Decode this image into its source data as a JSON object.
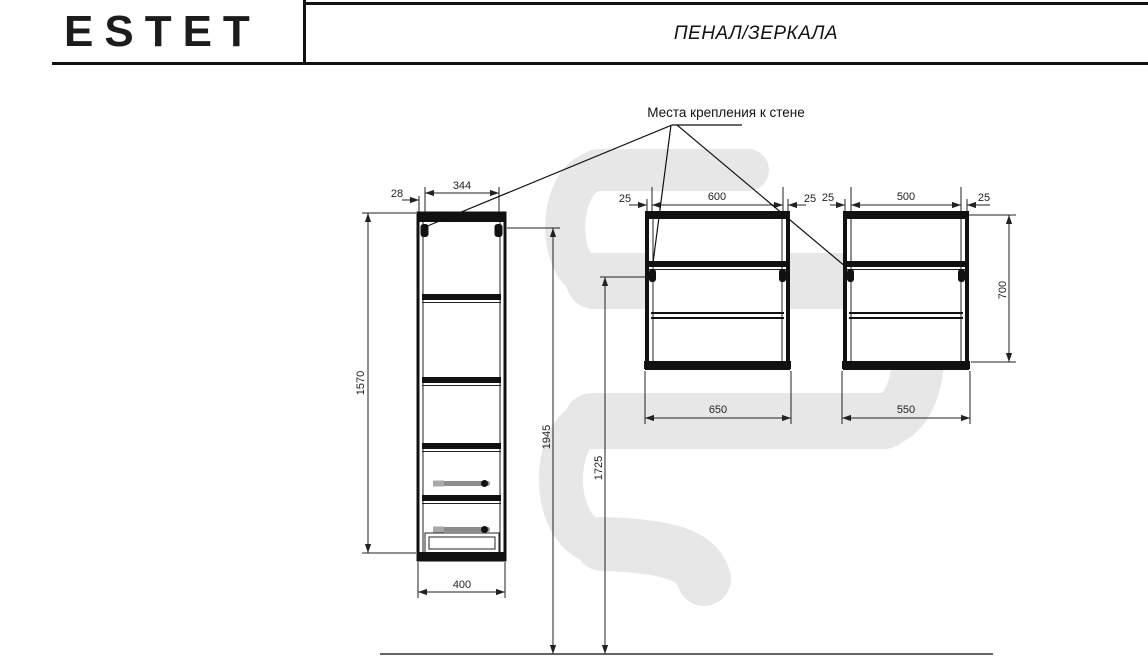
{
  "header": {
    "brand": "ESTET",
    "title": "ПЕНАЛ/ЗЕРКАЛА"
  },
  "annotation": {
    "wall_mount_label": "Места крепления к стене"
  },
  "drawings": {
    "tall_cabinet": {
      "offset_top": "28",
      "width_top": "344",
      "height": "1570",
      "width_bottom": "400",
      "total_height": "1945"
    },
    "wide_mirror": {
      "offset_left": "25",
      "width_top": "600",
      "offset_right": "25",
      "width_bottom": "650",
      "mount_height": "1725"
    },
    "small_mirror": {
      "offset_left": "25",
      "width_top": "500",
      "offset_right": "25",
      "width_bottom": "550",
      "height": "700"
    }
  },
  "colors": {
    "line": "#111111",
    "dimension": "#222222",
    "watermark": "#e7e7e7",
    "handle": "#8c8c8c"
  }
}
